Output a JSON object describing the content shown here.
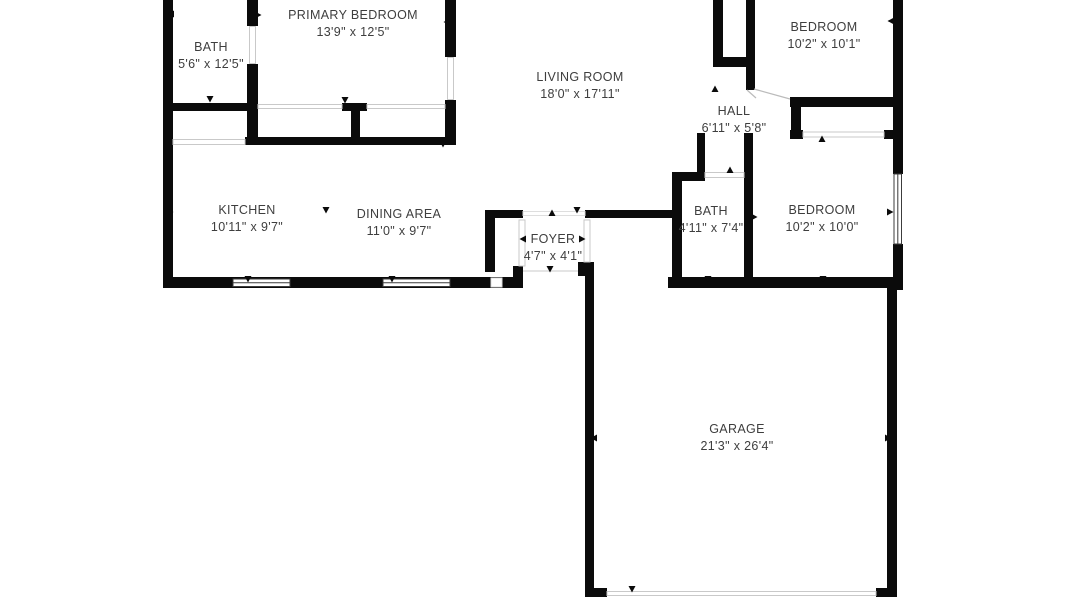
{
  "plan": {
    "type": "floor-plan",
    "colors": {
      "wall": "#0b0b0b",
      "text": "#3e3e3e",
      "opening_line": "#c9c9c9",
      "window_line": "#3c3c3c",
      "background": "#ffffff"
    },
    "rooms": [
      {
        "id": "bath-1",
        "name": "BATH",
        "dims": "5'6\" x 12'5\""
      },
      {
        "id": "primary-bedroom",
        "name": "PRIMARY BEDROOM",
        "dims": "13'9\" x 12'5\""
      },
      {
        "id": "living-room",
        "name": "LIVING ROOM",
        "dims": "18'0\" x 17'11\""
      },
      {
        "id": "bedroom-top",
        "name": "BEDROOM",
        "dims": "10'2\" x 10'1\""
      },
      {
        "id": "hall",
        "name": "HALL",
        "dims": "6'11\" x 5'8\""
      },
      {
        "id": "kitchen",
        "name": "KITCHEN",
        "dims": "10'11\" x 9'7\""
      },
      {
        "id": "dining-area",
        "name": "DINING AREA",
        "dims": "11'0\" x 9'7\""
      },
      {
        "id": "foyer",
        "name": "FOYER",
        "dims": "4'7\" x 4'1\""
      },
      {
        "id": "bath-2",
        "name": "BATH",
        "dims": "4'11\" x 7'4\""
      },
      {
        "id": "bedroom-right",
        "name": "BEDROOM",
        "dims": "10'2\" x 10'0\""
      },
      {
        "id": "garage",
        "name": "GARAGE",
        "dims": "21'3\" x 26'4\""
      }
    ]
  }
}
